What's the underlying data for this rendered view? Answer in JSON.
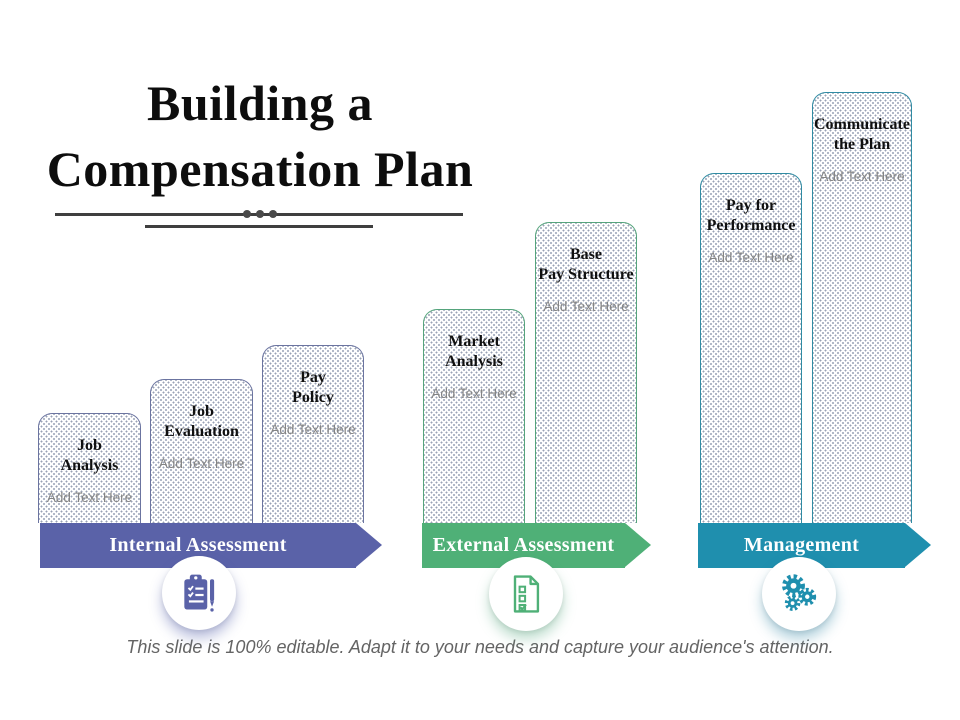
{
  "slide": {
    "title_line1": "Building a",
    "title_line2": "Compensation Plan",
    "caption": "This slide is 100% editable. Adapt it to your needs and capture your audience's attention."
  },
  "groups": [
    {
      "label": "Internal Assessment",
      "color": "#5a62a8",
      "border_color": "#6b74a0",
      "shadow_color": "rgba(100,110,180,0.45)",
      "icon": "clipboard-checklist-icon",
      "columns": [
        {
          "title": "Job\nAnalysis",
          "subtitle": "Add Text Here"
        },
        {
          "title": "Job\nEvaluation",
          "subtitle": "Add Text Here"
        },
        {
          "title": "Pay\nPolicy",
          "subtitle": "Add Text Here"
        }
      ]
    },
    {
      "label": "External Assessment",
      "color": "#4fb077",
      "border_color": "#55a47c",
      "shadow_color": "rgba(90,170,130,0.40)",
      "icon": "survey-form-icon",
      "columns": [
        {
          "title": "Market\nAnalysis",
          "subtitle": "Add Text Here"
        },
        {
          "title": "Base\nPay Structure",
          "subtitle": "Add Text Here"
        }
      ]
    },
    {
      "label": "Management",
      "color": "#1f8fae",
      "border_color": "#2f8ba3",
      "shadow_color": "rgba(60,140,170,0.40)",
      "icon": "gears-icon",
      "columns": [
        {
          "title": "Pay for\nPerformance",
          "subtitle": "Add Text Here"
        },
        {
          "title": "Communicate\nthe Plan",
          "subtitle": "Add Text Here"
        }
      ]
    }
  ]
}
